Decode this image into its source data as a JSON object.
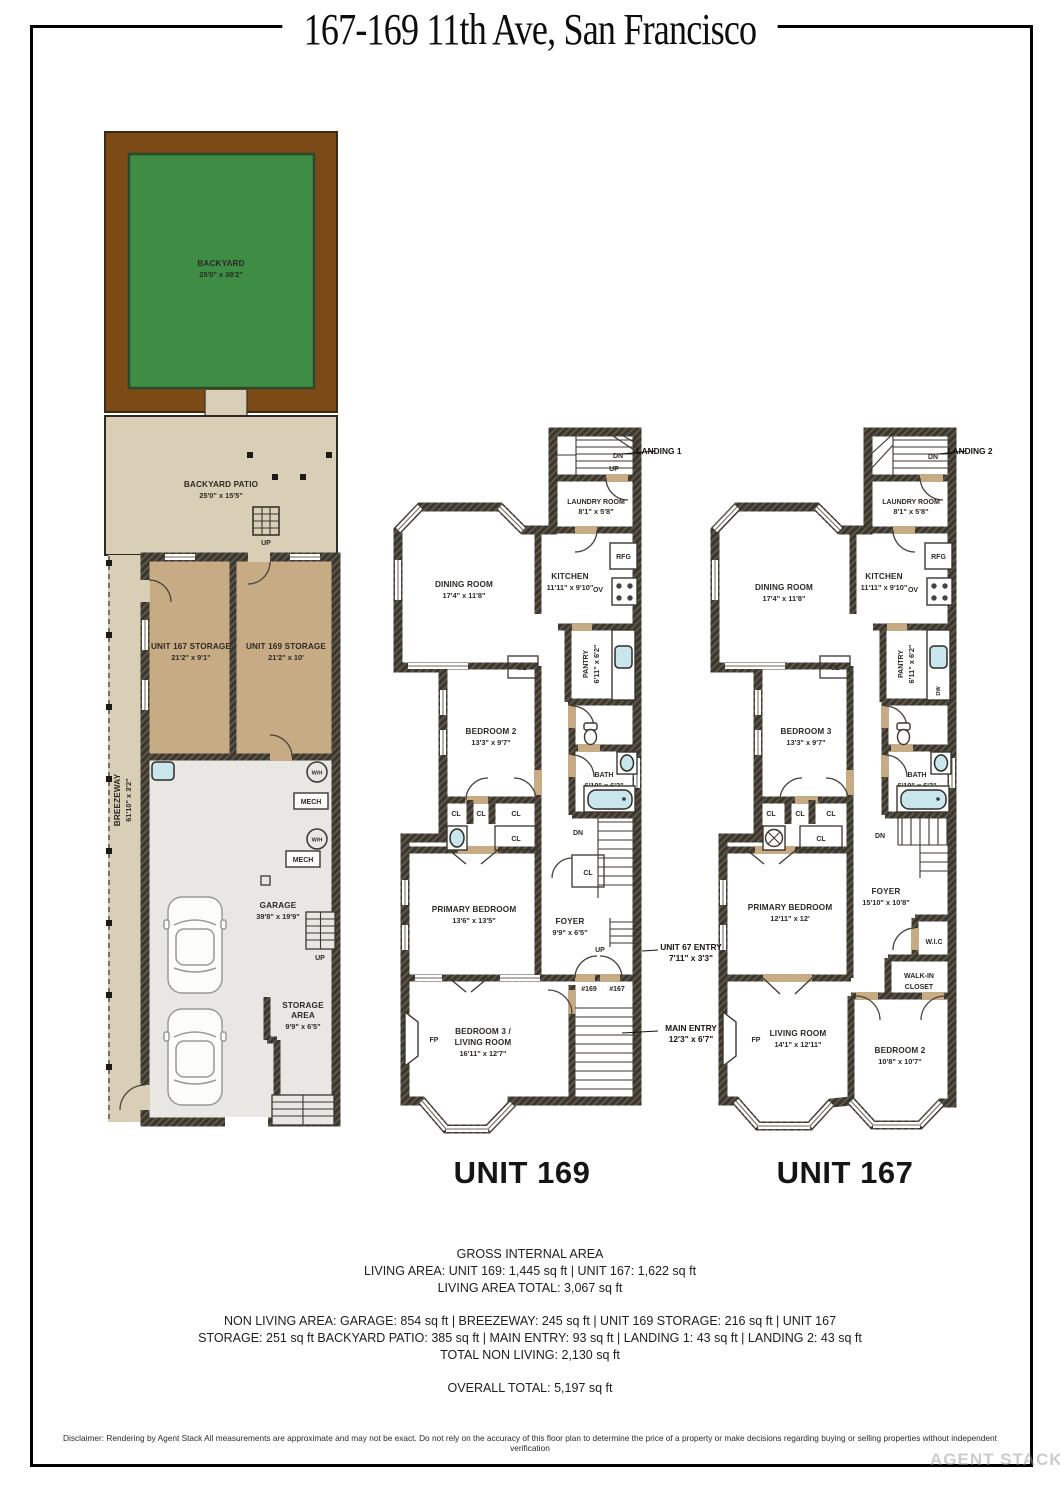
{
  "title": "167-169 11th Ave, San Francisco",
  "ground": {
    "backyard_name": "BACKYARD",
    "backyard_dims": "25'0\" x 38'2\"",
    "patio_name": "BACKYARD PATIO",
    "patio_dims": "25'0\" x 15'5\"",
    "patio_up": "UP",
    "storage167_name": "UNIT 167 STORAGE",
    "storage167_dims": "21'2\" x 9'1\"",
    "storage169_name": "UNIT 169 STORAGE",
    "storage169_dims": "21'2\" x 10'",
    "breezeway_name": "BREEZEWAY",
    "breezeway_dims": "61'10\" x 3'2\"",
    "garage_name": "GARAGE",
    "garage_dims": "39'8\" x 19'9\"",
    "garage_up": "UP",
    "storage_area_line1": "STORAGE",
    "storage_area_line2": "AREA",
    "storage_area_dims": "9'9\" x 6'5\"",
    "wh": "W/H",
    "mech": "MECH"
  },
  "unit169": {
    "title": "UNIT 169",
    "landing_note": "LANDING 1",
    "dn": "DN",
    "up": "UP",
    "laundry_name": "LAUNDRY ROOM",
    "laundry_dims": "8'1\" x 5'8\"",
    "dining_name": "DINING ROOM",
    "dining_dims": "17'4\" x 11'8\"",
    "kitchen_name": "KITCHEN",
    "kitchen_dims": "11'11\" x 9'10\"",
    "rfg": "RFG",
    "ov": "OV",
    "cl": "CL",
    "pantry_name": "PANTRY",
    "pantry_dims": "6'11\" x 6'2\"",
    "bedroom2_name": "BEDROOM 2",
    "bedroom2_dims": "13'3\" x 9'7\"",
    "bath_name": "BATH",
    "bath_dims": "6'10\" x 6'2\"",
    "primary_name": "PRIMARY BEDROOM",
    "primary_dims": "13'6\" x 13'5\"",
    "foyer_name": "FOYER",
    "foyer_dims": "9'9\" x 6'5\"",
    "entry_note_name": "UNIT 67 ENTRY",
    "entry_note_dims": "7'11\" x 3'3\"",
    "door169": "#169",
    "door167": "#167",
    "main_entry_name": "MAIN ENTRY",
    "main_entry_dims": "12'3\" x 6'7\"",
    "bedroom3_line1": "BEDROOM 3 /",
    "bedroom3_line2": "LIVING ROOM",
    "bedroom3_dims": "16'11\" x 12'7\"",
    "fp": "FP"
  },
  "unit167": {
    "title": "UNIT 167",
    "landing_note": "LANDING 2",
    "dn": "DN",
    "laundry_name": "LAUNDRY ROOM",
    "laundry_dims": "8'1\" x 5'8\"",
    "dining_name": "DINING ROOM",
    "dining_dims": "17'4\" x 11'8\"",
    "kitchen_name": "KITCHEN",
    "kitchen_dims": "11'11\" x 9'10\"",
    "rfg": "RFG",
    "ov": "OV",
    "dw": "DW",
    "cl": "CL",
    "pantry_name": "PANTRY",
    "pantry_dims": "6'11\" x 6'2\"",
    "bedroom3_name": "BEDROOM 3",
    "bedroom3_dims": "13'3\" x 9'7\"",
    "bath_name": "BATH",
    "bath_dims": "6'10\" x 6'2\"",
    "primary_name": "PRIMARY BEDROOM",
    "primary_dims": "12'11\" x 12'",
    "foyer_name": "FOYER",
    "foyer_dims": "15'10\" x 10'8\"",
    "wic": "W.I.C",
    "walkin_line1": "WALK-IN",
    "walkin_line2": "CLOSET",
    "living_name": "LIVING ROOM",
    "living_dims": "14'1\" x 12'11\"",
    "bedroom2_name": "BEDROOM 2",
    "bedroom2_dims": "10'8\" x 10'7\"",
    "fp": "FP"
  },
  "summary": {
    "heading": "GROSS INTERNAL AREA",
    "line1": "LIVING AREA: UNIT 169: 1,445 sq ft | UNIT 167: 1,622 sq ft",
    "line2": "LIVING AREA TOTAL: 3,067 sq ft",
    "line3": "NON LIVING AREA: GARAGE: 854 sq ft | BREEZEWAY: 245 sq ft | UNIT 169 STORAGE: 216 sq ft | UNIT 167",
    "line4": "STORAGE: 251 sq ft BACKYARD PATIO: 385 sq ft | MAIN ENTRY: 93 sq ft | LANDING 1: 43 sq ft | LANDING 2: 43 sq ft",
    "line5": "TOTAL NON LIVING: 2,130 sq ft",
    "total": "OVERALL TOTAL: 5,197 sq ft"
  },
  "disclaimer": "Disclaimer: Rendering by Agent Stack All measurements are approximate and may not be exact. Do not rely on the accuracy of this floor plan to determine the price of a property or make decisions regarding buying or selling properties without independent verification",
  "watermark": "AGENT STACK"
}
